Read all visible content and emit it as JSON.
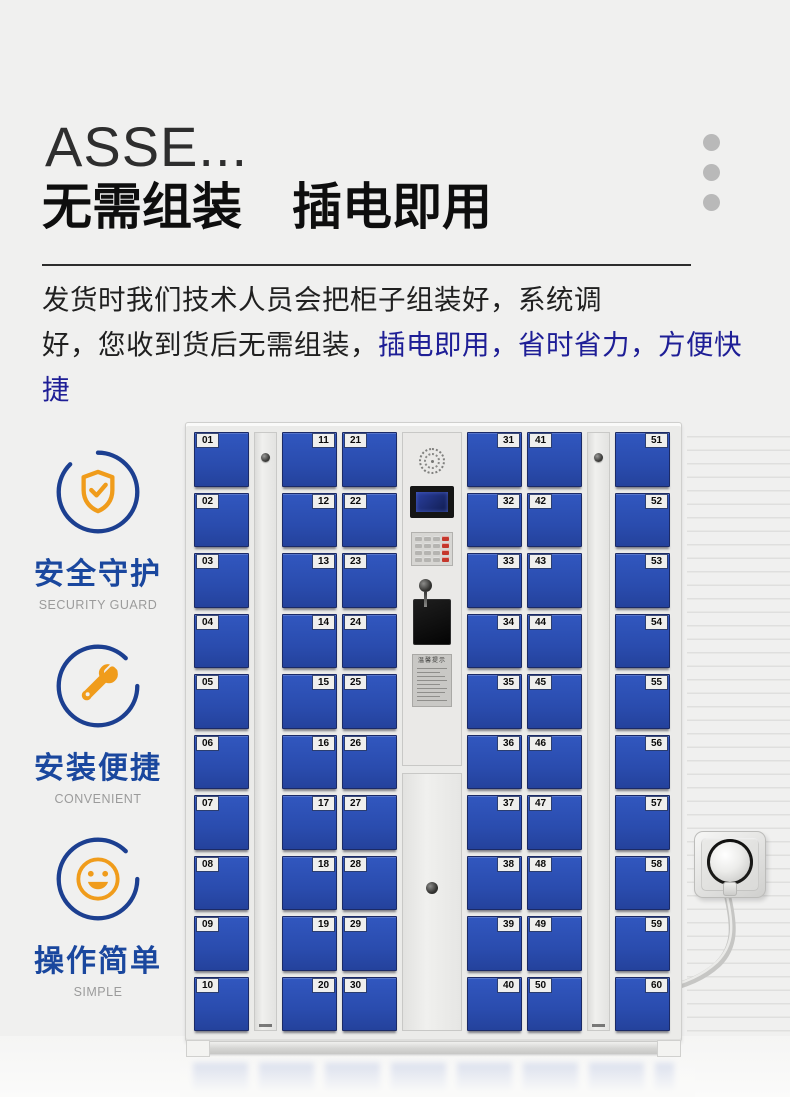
{
  "colors": {
    "page_bg": "#f0f0ef",
    "highlight_blue": "#1e1e96",
    "feature_blue": "#1a479e",
    "ring_blue": "#1c3f90",
    "icon_orange": "#f09c1b",
    "door_blue": "#2b50b3",
    "cabinet_gray": "#ebebe9"
  },
  "header": {
    "title_en": "ASSE...",
    "title_zh": "无需组装　插电即用"
  },
  "description": {
    "line1": "发货时我们技术人员会把柜子组装好，系统调",
    "line2_plain": "好，您收到货后无需组装，",
    "line2_highlight": "插电即用，省时省力，方便快捷"
  },
  "features": [
    {
      "icon": "shield-check-icon",
      "title": "安全守护",
      "subtitle": "SECURITY GUARD"
    },
    {
      "icon": "tools-icon",
      "title": "安装便捷",
      "subtitle": "CONVENIENT"
    },
    {
      "icon": "smiley-icon",
      "title": "操作简单",
      "subtitle": "SIMPLE"
    }
  ],
  "locker": {
    "notice_title": "温馨提示",
    "columns": [
      {
        "type": "doors",
        "label_side": "left",
        "numbers": [
          "01",
          "02",
          "03",
          "04",
          "05",
          "06",
          "07",
          "08",
          "09",
          "10"
        ]
      },
      {
        "type": "panel"
      },
      {
        "type": "doors",
        "label_side": "right",
        "numbers": [
          "11",
          "12",
          "13",
          "14",
          "15",
          "16",
          "17",
          "18",
          "19",
          "20"
        ]
      },
      {
        "type": "doors",
        "label_side": "left",
        "numbers": [
          "21",
          "22",
          "23",
          "24",
          "25",
          "26",
          "27",
          "28",
          "29",
          "30"
        ]
      },
      {
        "type": "control"
      },
      {
        "type": "doors",
        "label_side": "right",
        "numbers": [
          "31",
          "32",
          "33",
          "34",
          "35",
          "36",
          "37",
          "38",
          "39",
          "40"
        ]
      },
      {
        "type": "doors",
        "label_side": "left",
        "numbers": [
          "41",
          "42",
          "43",
          "44",
          "45",
          "46",
          "47",
          "48",
          "49",
          "50"
        ]
      },
      {
        "type": "panel"
      },
      {
        "type": "doors",
        "label_side": "right",
        "numbers": [
          "51",
          "52",
          "53",
          "54",
          "55",
          "56",
          "57",
          "58",
          "59",
          "60"
        ]
      }
    ]
  }
}
